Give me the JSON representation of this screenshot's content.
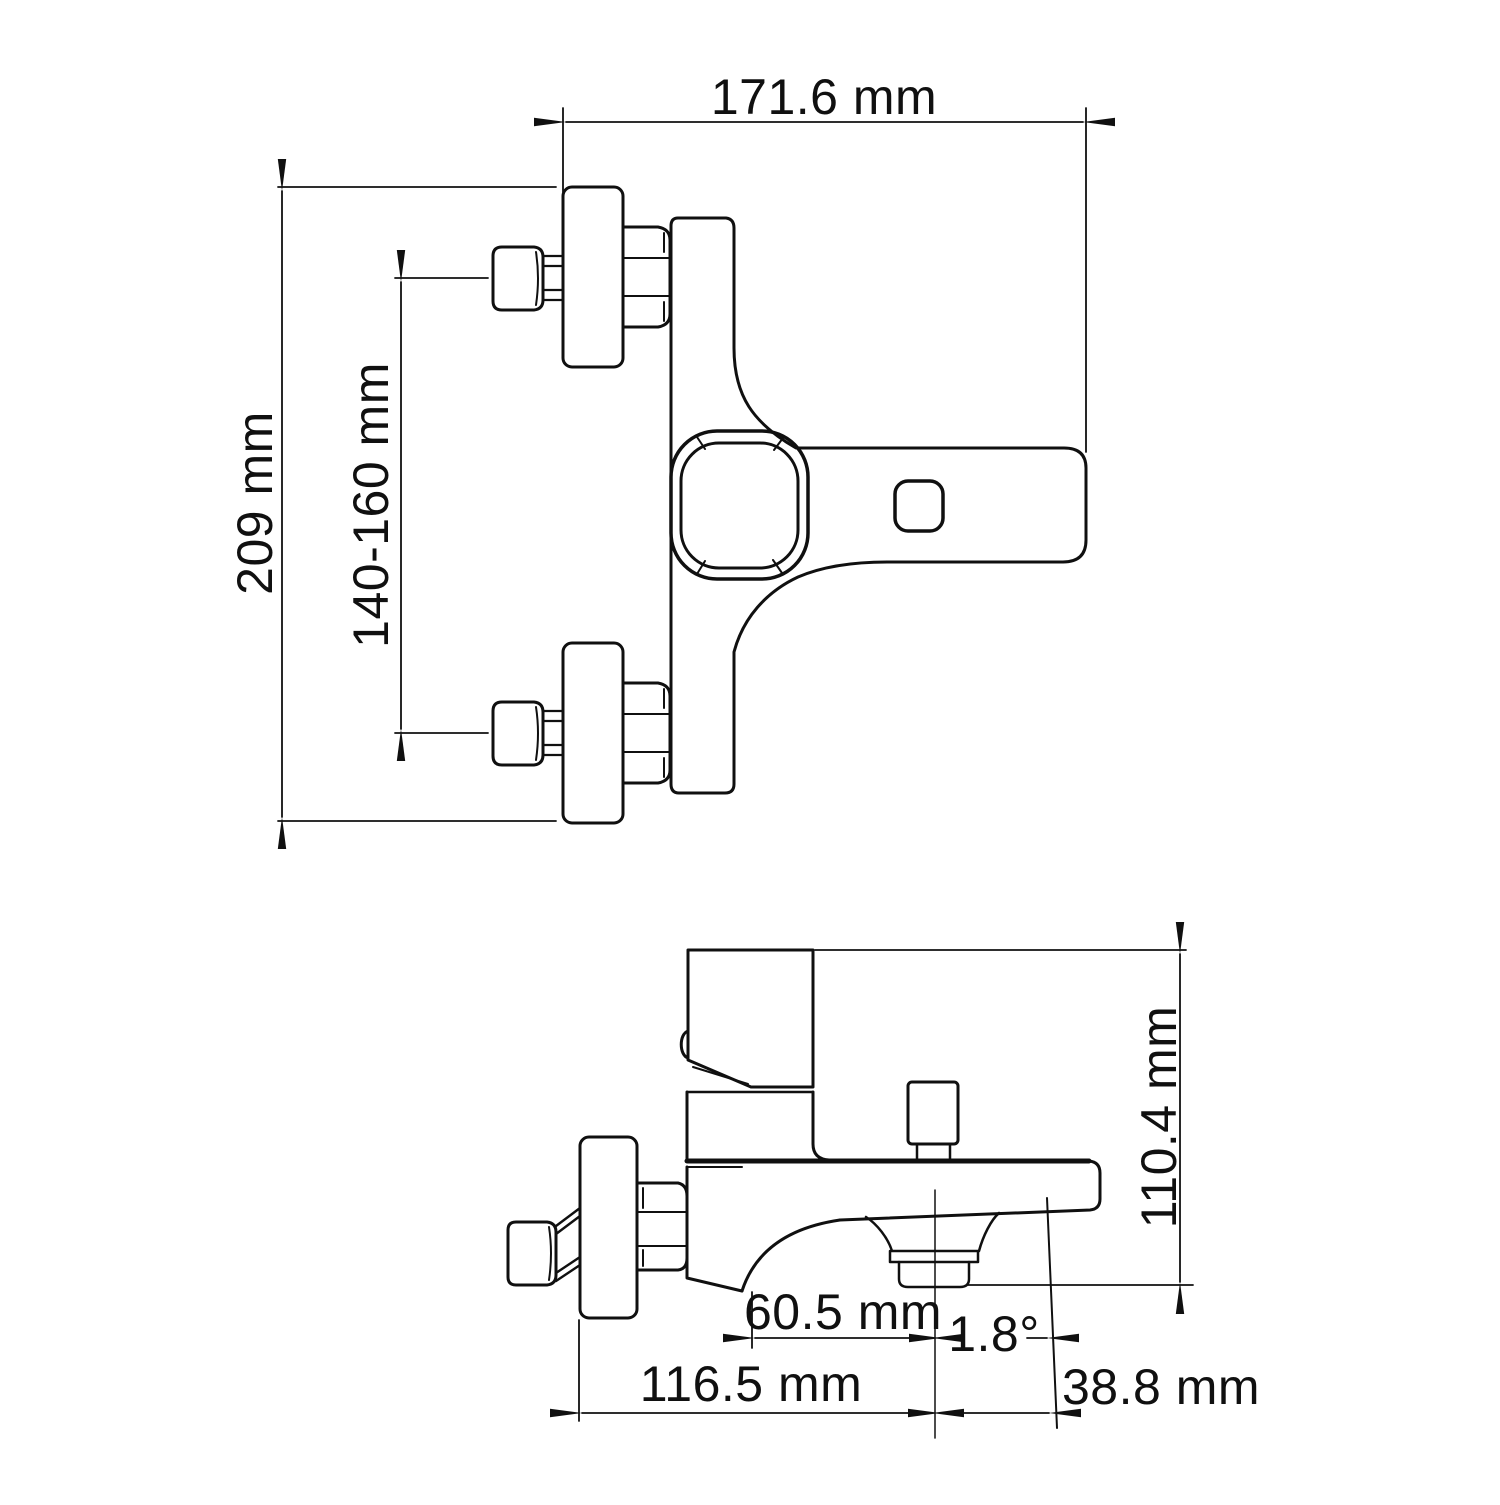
{
  "drawing": {
    "background": "#ffffff",
    "line_color": "#101010",
    "front_view": {
      "width_label": "171.6 mm",
      "height_label": "209 mm",
      "mount_span_label": "140-160 mm"
    },
    "side_view": {
      "height_label": "110.4 mm",
      "aerator_offset_label": "60.5 mm",
      "angle_label": "1.8°",
      "depth_label": "116.5 mm",
      "tip_offset_label": "38.8 mm"
    }
  }
}
